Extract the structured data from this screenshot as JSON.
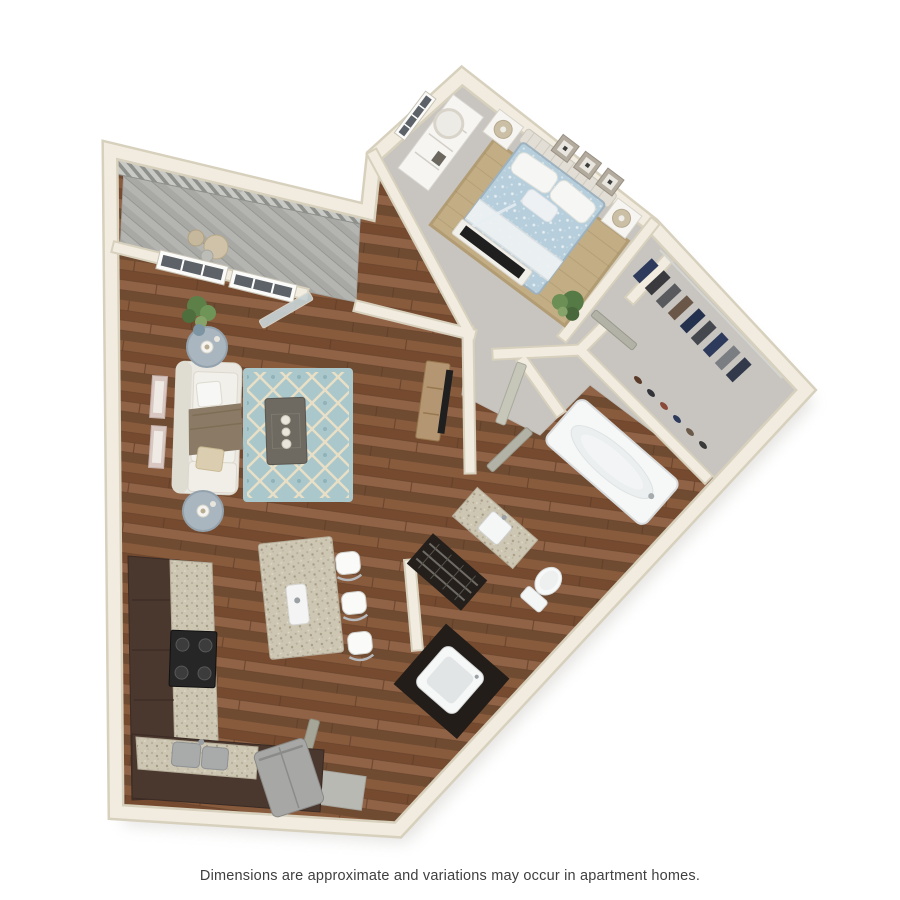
{
  "page": {
    "background": "#ffffff",
    "disclaimer": "Dimensions are approximate and variations may occur in apartment homes."
  },
  "floor_plan": {
    "view": "3d-top-down-render",
    "rooms": [
      {
        "name": "Bedroom",
        "floor": "carpet",
        "furniture": [
          "bed with light blue duvet",
          "headboard",
          "two nightstands",
          "two table lamps",
          "white dresser",
          "round mirror",
          "three wall art frames",
          "jute area rug",
          "tv on low stand",
          "corner plant",
          "window"
        ]
      },
      {
        "name": "Living Room",
        "floor": "hardwood",
        "furniture": [
          "white sofa",
          "brown throw blanket",
          "throw pillows",
          "two round side tables",
          "table lamps",
          "dark coffee table with candles",
          "teal trellis rug",
          "media console with tv",
          "two wall frames",
          "potted plant",
          "windows",
          "glass balcony door"
        ]
      },
      {
        "name": "Kitchen",
        "floor": "hardwood",
        "furniture": [
          "l-shaped dark cabinets",
          "granite countertops",
          "black range",
          "stainless sink",
          "refrigerator",
          "granite island with faucet",
          "three bar stools"
        ]
      },
      {
        "name": "Bathroom",
        "floor": "hardwood",
        "furniture": [
          "garden tub",
          "toilet",
          "granite vanity with sink",
          "linen shelves"
        ]
      },
      {
        "name": "Walk-in Closet",
        "floor": "carpet",
        "furniture": [
          "clothes rail",
          "hanging clothes",
          "shoe row"
        ]
      },
      {
        "name": "Balcony",
        "floor": "decking",
        "furniture": [
          "railing",
          "bistro chairs",
          "small table"
        ]
      },
      {
        "name": "Laundry Closet",
        "floor": "hardwood",
        "furniture": [
          "washer"
        ]
      },
      {
        "name": "Entry",
        "floor": "tile",
        "furniture": [
          "entry door",
          "tile landing"
        ]
      }
    ],
    "colors": {
      "wall": "#f1ecdf",
      "wall_edge": "#d7d0bd",
      "wood_floor": "#7d5437",
      "carpet": "#c8c5c0",
      "balcony_deck": "#b4b5b1",
      "teal_rug": "#aac8cc",
      "jute_rug": "#c3ad84",
      "cabinet": "#4a372e",
      "granite": "#cdc6b3",
      "bedding": "#b7cfdc",
      "white_fixture": "#f6f7f7",
      "stainless": "#a9abab",
      "tv": "#1f1f1f",
      "door": "#b2b2a6",
      "clothes_navy": "#2e3a5c",
      "plant": "#5d8049",
      "text": "#3f3f3f"
    }
  }
}
